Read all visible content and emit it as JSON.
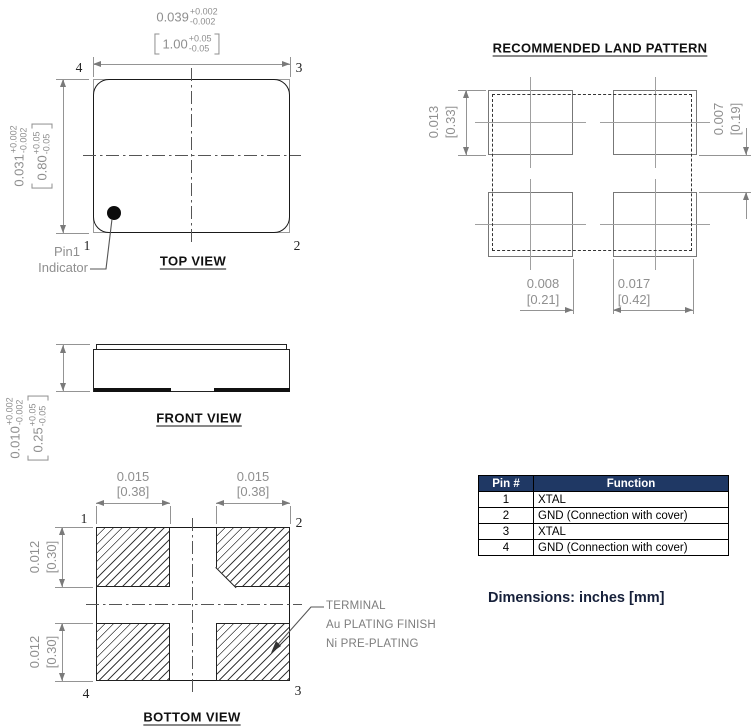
{
  "top_view": {
    "label": "TOP VIEW",
    "pins": {
      "p1": "1",
      "p2": "2",
      "p3": "3",
      "p4": "4"
    },
    "width_dim": {
      "inch": "0.039",
      "plus": "+0.002",
      "minus": "-0.002",
      "mm": "1.00",
      "mm_plus": "+0.05",
      "mm_minus": "-0.05"
    },
    "height_dim": {
      "inch": "0.031",
      "plus": "+0.002",
      "minus": "-0.002",
      "mm": "0.80",
      "mm_plus": "+0.05",
      "mm_minus": "-0.05"
    },
    "pin1_note": {
      "line1": "Pin1",
      "line2": "Indicator"
    }
  },
  "front_view": {
    "label": "FRONT VIEW",
    "height_dim": {
      "inch": "0.010",
      "plus": "+0.002",
      "minus": "-0.002",
      "mm": "0.25",
      "mm_plus": "+0.05",
      "mm_minus": "-0.05"
    }
  },
  "bottom_view": {
    "label": "BOTTOM VIEW",
    "pins": {
      "p1": "1",
      "p2": "2",
      "p3": "3",
      "p4": "4"
    },
    "pad_width": {
      "inch": "0.015",
      "mm": "[0.38]"
    },
    "pad_height": {
      "inch": "0.012",
      "mm": "[0.30]"
    },
    "terminal_note": {
      "line1": "TERMINAL",
      "line2": "Au PLATING FINISH",
      "line3": "Ni PRE-PLATING"
    }
  },
  "land_pattern": {
    "title": "RECOMMENDED LAND PATTERN",
    "pad_height": {
      "inch": "0.013",
      "mm": "[0.33]"
    },
    "row_gap": {
      "inch": "0.007",
      "mm": "[0.19]"
    },
    "col_gap": {
      "inch": "0.008",
      "mm": "[0.21]"
    },
    "pad_width": {
      "inch": "0.017",
      "mm": "[0.42]"
    }
  },
  "pin_table": {
    "headers": [
      "Pin #",
      "Function"
    ],
    "rows": [
      {
        "pin": "1",
        "function": "XTAL"
      },
      {
        "pin": "2",
        "function": "GND (Connection with cover)"
      },
      {
        "pin": "3",
        "function": "XTAL"
      },
      {
        "pin": "4",
        "function": "GND (Connection with cover)"
      }
    ]
  },
  "units_note": "Dimensions: inches [mm]"
}
